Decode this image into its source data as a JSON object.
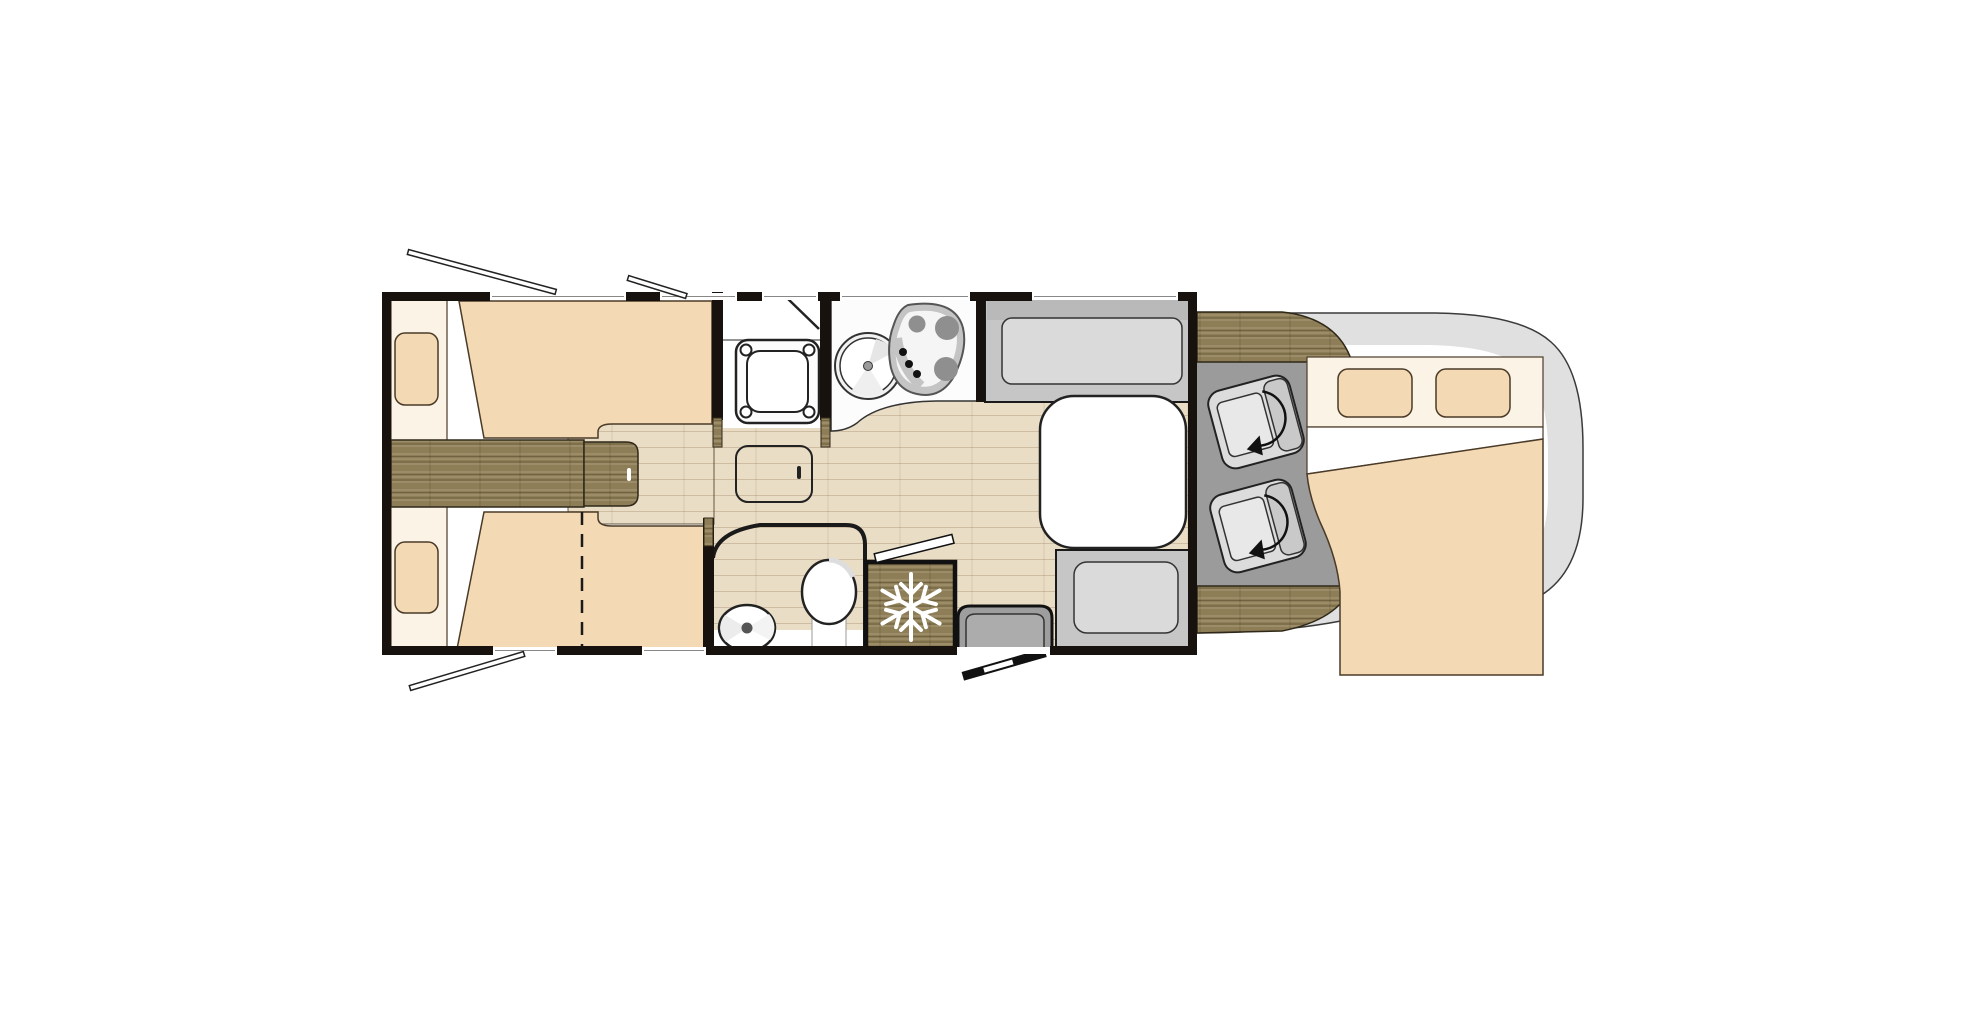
{
  "diagram": {
    "type": "motorhome-floorplan",
    "description_icons": {
      "fridge": "snowflake-icon",
      "cab_seats": "swivel-arrow-icon",
      "windows": "open-flap-icon",
      "entry": "open-door-icon"
    }
  },
  "palette": {
    "wall": "#17120e",
    "beige": "#f3d9b4",
    "cream": "#faf3e6",
    "bed_line": "#4a3a28",
    "wood": "#8d7e57",
    "floor": "#e9ddc6",
    "cab_gray": "#9b9b9b",
    "bench_gray": "#c6c6c6",
    "bench_cushion": "#dadada",
    "bench_back": "#b9b9b9",
    "seat_gray": "#dcdcdc",
    "seat_back": "#c9c9c9",
    "seat_cushion": "#e8e8e8",
    "body_gray": "#e0e0e0",
    "step_gray": "#9e9e9e",
    "step_inner": "#acacac",
    "counter_white": "#fcfcfc",
    "hob_ring": "#c4c4c4",
    "burner_gray": "#8f8f8f",
    "snowflake": "#ffffff"
  }
}
